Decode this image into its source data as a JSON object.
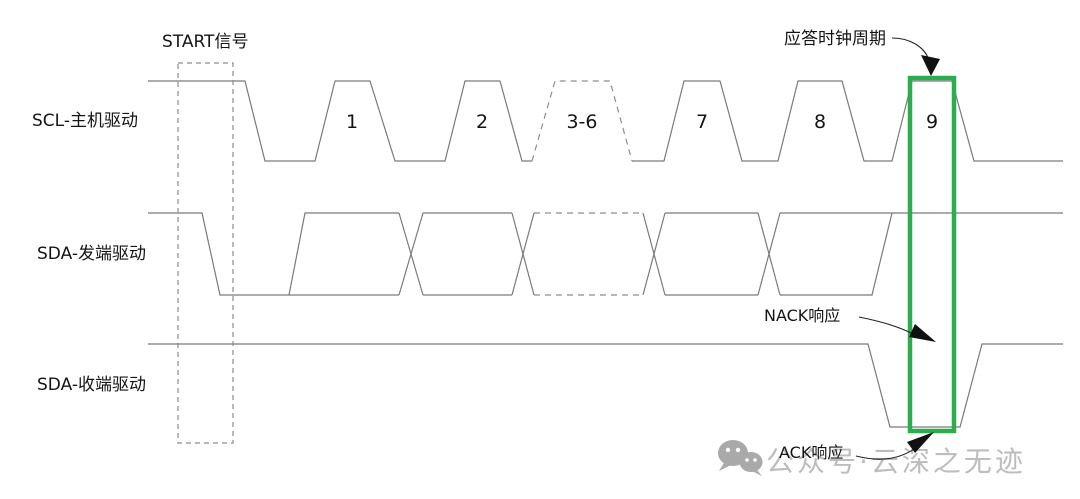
{
  "colors": {
    "background": "#ffffff",
    "waveform_line": "#7a7a7a",
    "dashed_line": "#8d8d8d",
    "text": "#141414",
    "accent_green": "#2bad4e",
    "watermark_gray": "#b6b6b6",
    "watermark_icon_gray": "#a9a9a9"
  },
  "rows": [
    {
      "id": "scl",
      "label": "SCL-主机驱动"
    },
    {
      "id": "sda_tx",
      "label": "SDA-发端驱动"
    },
    {
      "id": "sda_rx",
      "label": "SDA-收端驱动"
    }
  ],
  "annotations": {
    "start": {
      "text": "START信号"
    },
    "ack_clock": {
      "text": "应答时钟周期"
    },
    "nack": {
      "text": "NACK响应"
    },
    "ack": {
      "text": "ACK响应"
    }
  },
  "clock_numbers": {
    "y": 128,
    "items": [
      {
        "label": "1",
        "x": 352
      },
      {
        "label": "2",
        "x": 482
      },
      {
        "label": "3-6",
        "x": 582
      },
      {
        "label": "7",
        "x": 702
      },
      {
        "label": "8",
        "x": 820
      },
      {
        "label": "9",
        "x": 932
      }
    ]
  },
  "watermark": {
    "icon": "wechat-icon",
    "text": "公众号·云深之无迹"
  },
  "diagram": {
    "width": 1080,
    "height": 499,
    "levels": {
      "scl": {
        "high": 81,
        "low": 161
      },
      "sda_tx": {
        "high": 213,
        "low": 295
      },
      "sda_rx": {
        "high": 344,
        "low": 427
      }
    },
    "segments": [
      {
        "signal": "scl",
        "dashed": false,
        "points": [
          [
            148,
            81
          ],
          [
            245,
            81
          ],
          [
            265,
            161
          ],
          [
            315,
            161
          ],
          [
            335,
            81
          ],
          [
            370,
            81
          ],
          [
            395,
            161
          ],
          [
            445,
            161
          ],
          [
            465,
            81
          ],
          [
            500,
            81
          ],
          [
            522,
            161
          ],
          [
            532,
            161
          ]
        ]
      },
      {
        "signal": "scl",
        "dashed": true,
        "points": [
          [
            532,
            161
          ],
          [
            555,
            81
          ],
          [
            610,
            81
          ],
          [
            632,
            161
          ]
        ]
      },
      {
        "signal": "scl",
        "dashed": false,
        "points": [
          [
            632,
            161
          ],
          [
            664,
            161
          ],
          [
            684,
            81
          ],
          [
            720,
            81
          ],
          [
            742,
            161
          ],
          [
            778,
            161
          ],
          [
            798,
            81
          ],
          [
            842,
            81
          ],
          [
            864,
            161
          ],
          [
            892,
            161
          ],
          [
            912,
            81
          ],
          [
            952,
            81
          ],
          [
            974,
            161
          ],
          [
            1063,
            161
          ]
        ]
      },
      {
        "signal": "sda_tx",
        "dashed": false,
        "points": [
          [
            148,
            213
          ],
          [
            202,
            213
          ],
          [
            220,
            295
          ],
          [
            399,
            295
          ]
        ]
      },
      {
        "signal": "sda_tx",
        "dashed": false,
        "points": [
          [
            289,
            295
          ],
          [
            305,
            213
          ],
          [
            399,
            213
          ]
        ]
      },
      {
        "signal": "sda_tx",
        "dashed": false,
        "points": [
          [
            399,
            213
          ],
          [
            423,
            295
          ]
        ]
      },
      {
        "signal": "sda_tx",
        "dashed": false,
        "points": [
          [
            399,
            295
          ],
          [
            423,
            213
          ]
        ]
      },
      {
        "signal": "sda_tx",
        "dashed": false,
        "points": [
          [
            423,
            213
          ],
          [
            512,
            213
          ]
        ]
      },
      {
        "signal": "sda_tx",
        "dashed": false,
        "points": [
          [
            423,
            295
          ],
          [
            512,
            295
          ]
        ]
      },
      {
        "signal": "sda_tx",
        "dashed": false,
        "points": [
          [
            512,
            213
          ],
          [
            534,
            295
          ]
        ]
      },
      {
        "signal": "sda_tx",
        "dashed": false,
        "points": [
          [
            512,
            295
          ],
          [
            534,
            213
          ]
        ]
      },
      {
        "signal": "sda_tx",
        "dashed": true,
        "points": [
          [
            534,
            213
          ],
          [
            643,
            213
          ]
        ]
      },
      {
        "signal": "sda_tx",
        "dashed": true,
        "points": [
          [
            534,
            295
          ],
          [
            643,
            295
          ]
        ]
      },
      {
        "signal": "sda_tx",
        "dashed": false,
        "points": [
          [
            643,
            213
          ],
          [
            665,
            295
          ]
        ]
      },
      {
        "signal": "sda_tx",
        "dashed": false,
        "points": [
          [
            643,
            295
          ],
          [
            665,
            213
          ]
        ]
      },
      {
        "signal": "sda_tx",
        "dashed": false,
        "points": [
          [
            665,
            213
          ],
          [
            758,
            213
          ]
        ]
      },
      {
        "signal": "sda_tx",
        "dashed": false,
        "points": [
          [
            665,
            295
          ],
          [
            758,
            295
          ]
        ]
      },
      {
        "signal": "sda_tx",
        "dashed": false,
        "points": [
          [
            758,
            213
          ],
          [
            780,
            295
          ]
        ]
      },
      {
        "signal": "sda_tx",
        "dashed": false,
        "points": [
          [
            758,
            295
          ],
          [
            780,
            213
          ]
        ]
      },
      {
        "signal": "sda_tx",
        "dashed": false,
        "points": [
          [
            780,
            213
          ],
          [
            1063,
            213
          ]
        ]
      },
      {
        "signal": "sda_tx",
        "dashed": false,
        "points": [
          [
            780,
            295
          ],
          [
            872,
            295
          ],
          [
            892,
            213
          ]
        ]
      },
      {
        "signal": "sda_rx",
        "dashed": false,
        "points": [
          [
            148,
            344
          ],
          [
            868,
            344
          ],
          [
            890,
            427
          ],
          [
            960,
            427
          ],
          [
            982,
            344
          ],
          [
            1063,
            344
          ]
        ]
      }
    ],
    "start_box": {
      "x": 178,
      "y": 63,
      "width": 55,
      "height": 380
    },
    "ack_window_box": {
      "x": 910,
      "y": 78,
      "width": 44,
      "height": 353,
      "stroke_width": 4.5
    },
    "arrows": [
      {
        "id": "ack-clock-arrow",
        "path": "M 892,38 C 909,38 924,46 929,60",
        "head": [
          [
            931,
            76
          ],
          [
            921,
            55
          ],
          [
            940,
            59
          ]
        ]
      },
      {
        "id": "nack-arrow",
        "path": "M 859,317 C 884,322 900,327 913,334",
        "head": [
          [
            936,
            342
          ],
          [
            915,
            324
          ],
          [
            909,
            337
          ]
        ]
      },
      {
        "id": "ack-arrow",
        "path": "M 856,456 C 884,463 903,458 920,445",
        "head": [
          [
            934,
            432
          ],
          [
            907,
            442
          ],
          [
            915,
            453
          ]
        ]
      }
    ]
  }
}
